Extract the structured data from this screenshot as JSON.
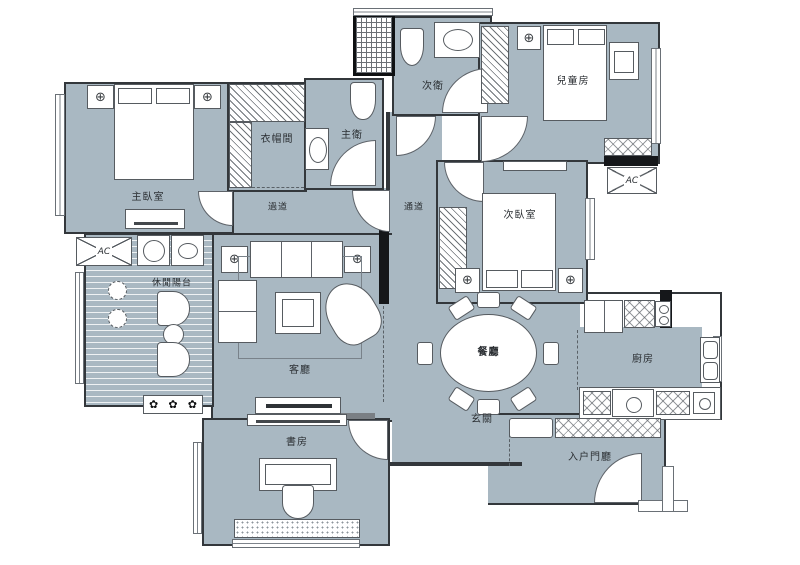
{
  "document": {
    "type": "apartment-floor-plan",
    "style": "interior CAD drawing"
  },
  "colors": {
    "room-fill": "#a9b8c2",
    "wall": "#33373b",
    "line": "#565b60",
    "paper": "#ffffff"
  },
  "rooms": {
    "master_bedroom": {
      "label": "主臥室"
    },
    "cloakroom": {
      "label": "衣帽間"
    },
    "master_bath": {
      "label": "主衛"
    },
    "corridor_west": {
      "label": "過道"
    },
    "corridor_mid": {
      "label": "通道"
    },
    "second_bath": {
      "label": "次衛"
    },
    "kids_room": {
      "label": "兒童房"
    },
    "second_bedroom": {
      "label": "次臥室"
    },
    "living_room": {
      "label": "客廳"
    },
    "balcony": {
      "label": "休閒陽台"
    },
    "dining_room": {
      "label": "餐廳"
    },
    "kitchen": {
      "label": "廚房"
    },
    "entry_hall": {
      "label": "玄關"
    },
    "foyer": {
      "label": "入户門廳"
    },
    "study": {
      "label": "書房"
    }
  },
  "equipment": {
    "ac": {
      "label": "AC"
    }
  },
  "symbols": {
    "ceiling_light": "⊕",
    "plant": "✿"
  }
}
